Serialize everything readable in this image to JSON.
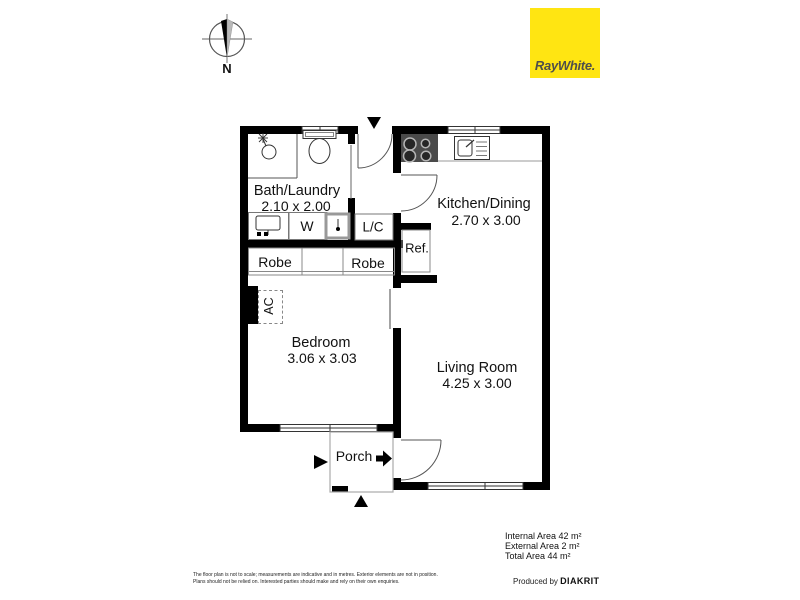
{
  "compass": {
    "north_label": "N"
  },
  "logo": {
    "brand": "RayWhite.",
    "bg_color": "#FFE512",
    "text_color": "#4F4F4B"
  },
  "plan": {
    "bath": {
      "name": "Bath/Laundry",
      "dims": "2.10 x 2.00"
    },
    "kitchen": {
      "name": "Kitchen/Dining",
      "dims": "2.70 x 3.00"
    },
    "bedroom": {
      "name": "Bedroom",
      "dims": "3.06 x 3.03"
    },
    "living": {
      "name": "Living Room",
      "dims": "4.25 x 3.00"
    },
    "porch": {
      "name": "Porch"
    },
    "labels": {
      "washer": "W",
      "linen": "L/C",
      "fridge": "Ref.",
      "robe1": "Robe",
      "robe2": "Robe",
      "ac": "AC"
    },
    "wall_color": "#000000"
  },
  "areas": {
    "internal": "Internal Area 42 m²",
    "external": "External Area 2 m²",
    "total": "Total Area 44 m²"
  },
  "credit": {
    "prefix": "Produced by",
    "brand": "DIAKRIT"
  },
  "disclaimer": {
    "line1": "The floor plan is not to scale; measurements are indicative and in metres. Exterior elements are not in position.",
    "line2": "Plans should not be relied on. Interested parties should make and rely on their own enquiries."
  }
}
